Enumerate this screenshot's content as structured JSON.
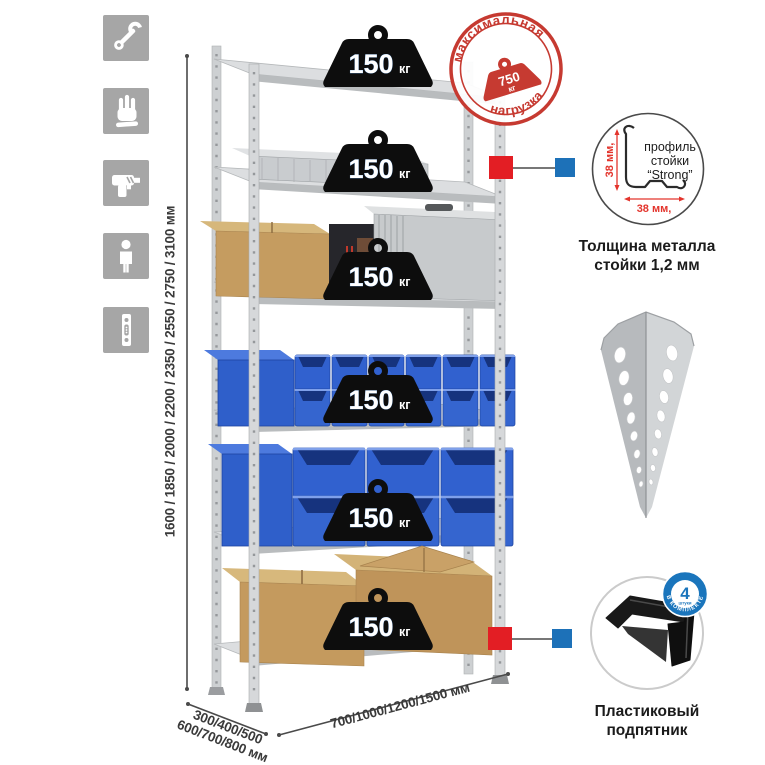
{
  "shelf_load": {
    "value": "150",
    "unit": "кг"
  },
  "stamp": {
    "arc_top": "максимальная",
    "arc_bottom": "нагрузка",
    "value": "750",
    "unit": "кг"
  },
  "dimensions": {
    "height": "1600 / 1850 / 2000 / 2200 / 2350 / 2550 / 2750 / 3100 мм",
    "depth1": "300/400/500",
    "depth2": "600/700/800 мм",
    "width": "700/1000/1200/1500 мм"
  },
  "profile_detail": {
    "dim_vertical": "38 мм,",
    "dim_horizontal": "38 мм,",
    "label1": "профиль",
    "label2": "стойки",
    "label3": "“Strong”",
    "caption1": "Толщина металла",
    "caption2": "стойки 1,2 мм"
  },
  "foot_detail": {
    "badge_number": "4",
    "badge_word": "штуки",
    "badge_arc": "в комплекте",
    "caption1": "Пластиковый",
    "caption2": "подпятник"
  },
  "icons": [
    "wrench",
    "gloves",
    "drill",
    "person",
    "post-profile"
  ],
  "colors": {
    "stamp_red": "#c63a31",
    "marker_red": "#e31e24",
    "marker_blue": "#1d71b8",
    "badge_blue": "#1a75bc",
    "bin_blue": "#3161cf",
    "cardboard": "#c49a5e",
    "metal": "#d6d8da",
    "icon_tile": "#a6a6a6"
  }
}
